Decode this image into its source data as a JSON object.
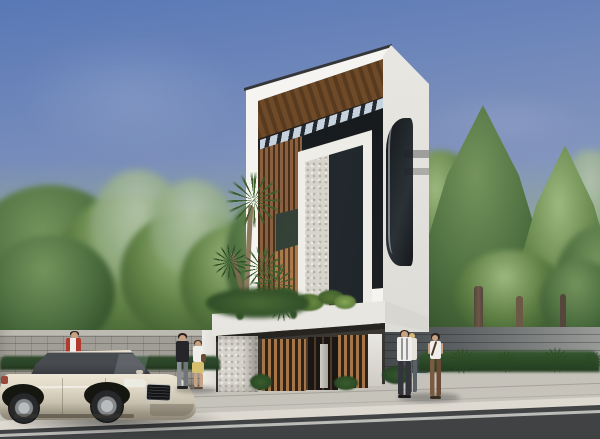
{
  "scene": {
    "description": "Photorealistic architectural rendering of a narrow modern three-story white townhouse with timber louvers and a slanted pergola roof, flanked by dense street trees behind concrete boundary walls, with a champagne sedan parked at the curb and six pedestrians on the sidewalk",
    "objects": [
      "sky",
      "street trees",
      "concrete block boundary wall",
      "paneled boundary wall",
      "modern three-story townhouse",
      "timber pergola roof",
      "timber louver facade",
      "stone-clad column",
      "carport with timber slat gates",
      "roof garden planting",
      "yucca plant",
      "hedge row",
      "sidewalk",
      "curb",
      "asphalt road",
      "white lane line",
      "champagne sedan",
      "six pedestrians"
    ]
  },
  "colors": {
    "sky-top": "#5878b6",
    "sky-mid": "#8b9cc0",
    "sky-low": "#cfd8e4",
    "tree-light": "#9db97f",
    "tree-mid": "#5f8045",
    "tree-dark": "#3c5a2e",
    "tree-haze": "#b9c8b0",
    "trunk": "#6b5946",
    "wall-block": "#a19e97",
    "wall-cap": "#bdbab2",
    "wall-right": "#8b8e8c",
    "wall-right-dark": "#43484a",
    "pillar-white": "#eceae4",
    "building-white": "#f5f4f0",
    "building-shade": "#d9d7d1",
    "roof-line": "#35363a",
    "soffit-wood": "#6e4a28",
    "soffit-wood-dark": "#583a1e",
    "slat-dark": "#23292e",
    "sky-gap": "#c6d2de",
    "louver-wood": "#8a6140",
    "louver-gap": "#4a3019",
    "rail-wood": "#a87a4c",
    "rail-gap": "#5c3e24",
    "stone": "#d7d4cc",
    "glass-dark": "#15181b",
    "glass-mid": "#232a2f",
    "canopy-white": "#f2f1ed",
    "carport-dark": "#332f29",
    "gate-wood": "#a5754a",
    "gate-gap": "#2e2318",
    "plant-bright": "#7ca24f",
    "plant-mid": "#557538",
    "plant-dark": "#35542a",
    "hedge": "#2b4429",
    "frond": "#3d5f2e",
    "sidewalk": "#bcb9b1",
    "curb": "#ddd9d0",
    "road": "#4c4e50",
    "road-line": "#d9d9d6",
    "car-body": "#ded6c5",
    "car-body-dark": "#8d8575",
    "car-glass": "#34373b",
    "car-grille": "#141517",
    "tire": "#151617",
    "alloy": "#b9bcbe",
    "taillight": "#99493c",
    "skin": "#c9a183",
    "hair-dark": "#2a211c",
    "hair-blonde": "#d8b878",
    "hair-brown": "#4a3424",
    "cloth-white": "#efeeea",
    "cloth-red": "#b23a2c",
    "cloth-black": "#26262a",
    "cloth-jeans": "#8a8f96",
    "skirt-yellow": "#d6c070",
    "pants-brown": "#7a5a40",
    "pants-dark": "#34343c",
    "bag-brown": "#6b4a2e"
  }
}
